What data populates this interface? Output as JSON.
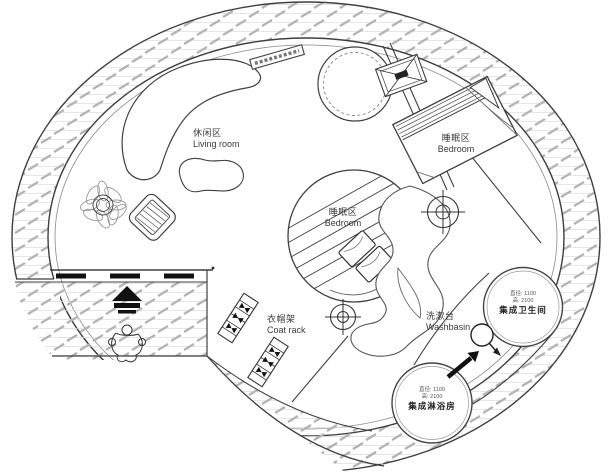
{
  "areas": {
    "living": {
      "zh": "休闲区",
      "en": "Living room"
    },
    "bedroom_upper": {
      "zh": "睡眠区",
      "en": "Bedroom"
    },
    "bedroom_center": {
      "zh": "睡眠区",
      "en": "Bedroom"
    },
    "coat_rack": {
      "zh": "衣帽架",
      "en": "Coat rack"
    },
    "washbasin": {
      "zh": "洗漱台",
      "en": "Washbasin"
    }
  },
  "pods": {
    "bathroom": {
      "name": "集成卫生间",
      "dim1": "直径: 1100",
      "dim2": "高: 2100"
    },
    "shower": {
      "name": "集成淋浴房",
      "dim1": "直径: 1100",
      "dim2": "高: 2100"
    }
  },
  "colors": {
    "line": "#3f3f3f",
    "hatch": "#b3b3b3",
    "background": "#ffffff"
  },
  "symbols": [
    "ceiling-light-crosshair",
    "skylight-x-box",
    "round-table",
    "rotation-loop-arrow",
    "direction-arrow",
    "entry-arrow",
    "person-figure",
    "potted-plant",
    "armchair",
    "curved-sofa",
    "coffee-table",
    "wall-shelf",
    "coat-rack",
    "double-bed",
    "pillows"
  ]
}
